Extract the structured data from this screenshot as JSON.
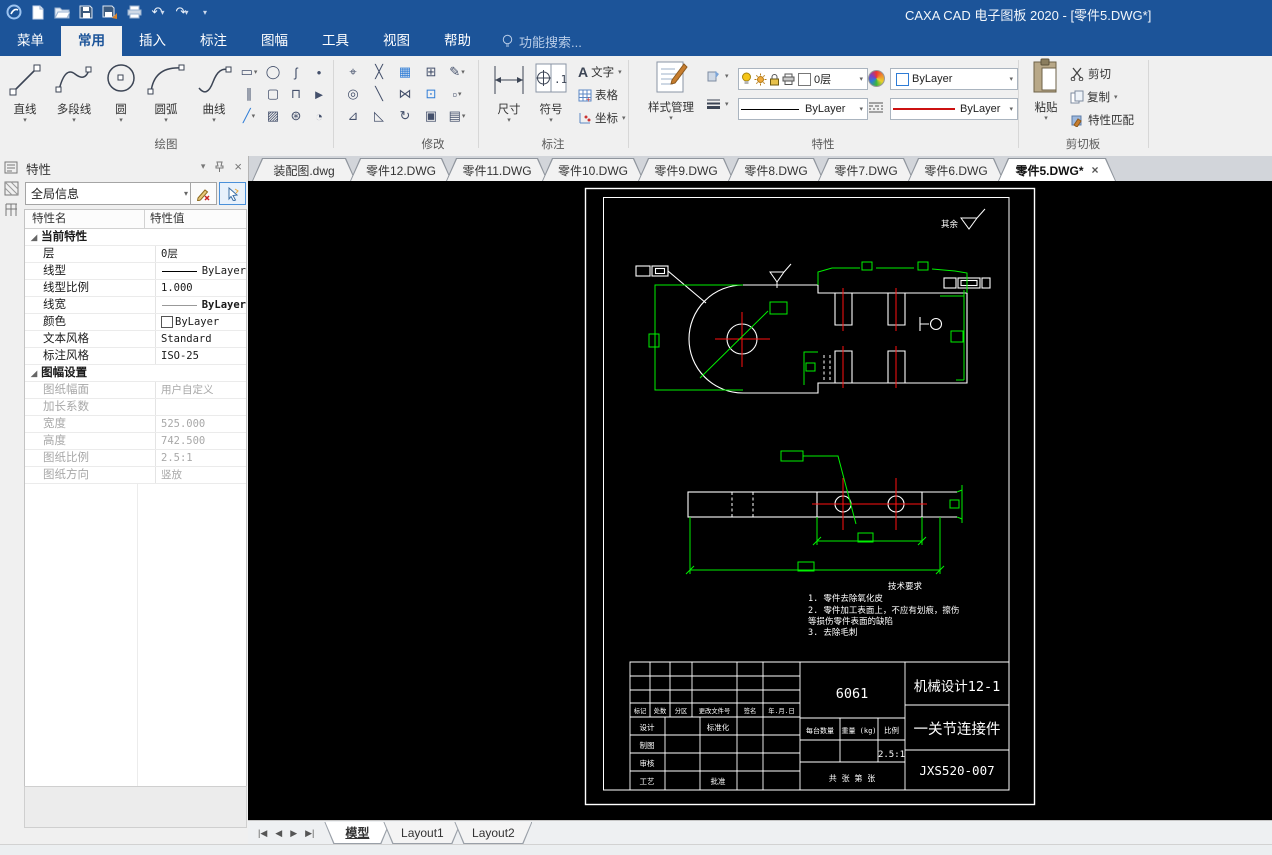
{
  "window": {
    "title": "CAXA CAD 电子图板 2020 - [零件5.DWG*]"
  },
  "menu": {
    "tabs": [
      "菜单",
      "常用",
      "插入",
      "标注",
      "图幅",
      "工具",
      "视图",
      "帮助"
    ],
    "active_tab": "常用",
    "search_placeholder": "功能搜索..."
  },
  "ribbon": {
    "draw": {
      "label": "绘图",
      "line": "直线",
      "polyline": "多段线",
      "circle": "圆",
      "arc": "圆弧",
      "curve": "曲线"
    },
    "modify": {
      "label": "修改"
    },
    "annotate": {
      "label": "标注",
      "dimension": "尺寸",
      "symbol": "符号",
      "text": "文字",
      "table": "表格",
      "coord": "坐标"
    },
    "props": {
      "label": "特性",
      "style_manager": "样式管理",
      "layer": "0层",
      "linetype": "ByLayer",
      "color": "ByLayer",
      "lineweight": "ByLayer"
    },
    "clipboard": {
      "label": "剪切板",
      "paste": "粘贴",
      "cut": "剪切",
      "copy": "复制",
      "match": "特性匹配"
    }
  },
  "doc_tabs": [
    "装配图.dwg",
    "零件12.DWG",
    "零件11.DWG",
    "零件10.DWG",
    "零件9.DWG",
    "零件8.DWG",
    "零件7.DWG",
    "零件6.DWG",
    "零件5.DWG*"
  ],
  "props_panel": {
    "title": "特性",
    "scope": "全局信息",
    "col_name": "特性名",
    "col_value": "特性值",
    "rows": [
      {
        "name": "当前特性",
        "value": ""
      },
      {
        "name": "层",
        "value": "0层"
      },
      {
        "name": "线型",
        "value": "ByLayer"
      },
      {
        "name": "线型比例",
        "value": "1.000"
      },
      {
        "name": "线宽",
        "value": "ByLayer"
      },
      {
        "name": "颜色",
        "value": "ByLayer"
      },
      {
        "name": "文本风格",
        "value": "Standard"
      },
      {
        "name": "标注风格",
        "value": "ISO-25"
      },
      {
        "name": "图幅设置",
        "value": ""
      },
      {
        "name": "图纸幅面",
        "value": "用户自定义"
      },
      {
        "name": "加长系数",
        "value": ""
      },
      {
        "name": "宽度",
        "value": "525.000"
      },
      {
        "name": "高度",
        "value": "742.500"
      },
      {
        "name": "图纸比例",
        "value": "2.5:1"
      },
      {
        "name": "图纸方向",
        "value": "竖放"
      }
    ]
  },
  "drawing": {
    "surface_note": "其余",
    "tech_req": [
      "技术要求",
      "1. 零件去除氧化皮",
      "2. 零件加工表面上，不应有划痕，擦伤",
      "等损伤零件表面的缺陷",
      "3. 去除毛刺"
    ],
    "title_block": {
      "material": "6061",
      "class_name": "机械设计12-1",
      "part_name": "一关节连接件",
      "drawing_no": "JXS520-007",
      "scale_value": "2.5:1",
      "h1": "标记",
      "h2": "处数",
      "h3": "分区",
      "h4": "更改文件号",
      "h5": "签名",
      "h6": "年.月.日",
      "r1": "设计",
      "r2": "制图",
      "r3": "审核",
      "r4": "工艺",
      "m1": "标准化",
      "m2": "批准",
      "qty_label": "每台数量",
      "weight_label": "重量 (kg)",
      "scale_label": "比例",
      "sheet_label": "共  张  第  张"
    },
    "colors": {
      "outline": "#ffffff",
      "dimension": "#00f000",
      "centerline": "#ff1111",
      "paper_bg": "#000000"
    }
  },
  "model_bar": {
    "tabs": [
      "模型",
      "Layout1",
      "Layout2"
    ],
    "active": "模型"
  }
}
